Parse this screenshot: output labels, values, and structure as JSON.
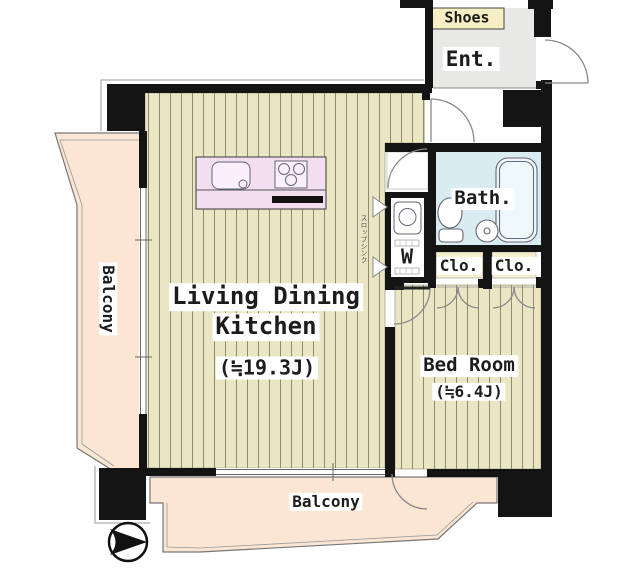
{
  "title": "Apartment floor plan",
  "labels": {
    "shoes": "Shoes",
    "entrance": "Ent.",
    "bath": "Bath.",
    "closet_a": "Clo.",
    "closet_b": "Clo.",
    "washer": "W",
    "ldk_line1": "Living Dining",
    "ldk_line2": "Kitchen",
    "ldk_size": "(≒19.3J)",
    "bedroom_name": "Bed Room",
    "bedroom_size": "(≒6.4J)",
    "balcony_left": "Balcony",
    "balcony_bottom": "Balcony",
    "utility_note": "スロップシンク"
  },
  "rooms": [
    {
      "name": "Living Dining Kitchen",
      "size_tatami": "≒19.3J"
    },
    {
      "name": "Bed Room",
      "size_tatami": "≒6.4J"
    },
    {
      "name": "Bath."
    },
    {
      "name": "Ent."
    },
    {
      "name": "Clo."
    },
    {
      "name": "Clo."
    },
    {
      "name": "Balcony (left)"
    },
    {
      "name": "Balcony (bottom)"
    }
  ],
  "colors": {
    "wall": "#141414",
    "wood_floor": "#eae5c3",
    "floor_stripe": "#8f8b73",
    "balcony_floor": "#fbe5d3",
    "bath_floor": "#d9ecf2",
    "entrance_floor": "#e8e8e6",
    "shoes_cabinet": "#f6efc4",
    "closet_floor": "#f4eecd",
    "kitchen_counter": "#f3ddf1"
  },
  "compass": {
    "direction": "east-pointing arrow"
  }
}
